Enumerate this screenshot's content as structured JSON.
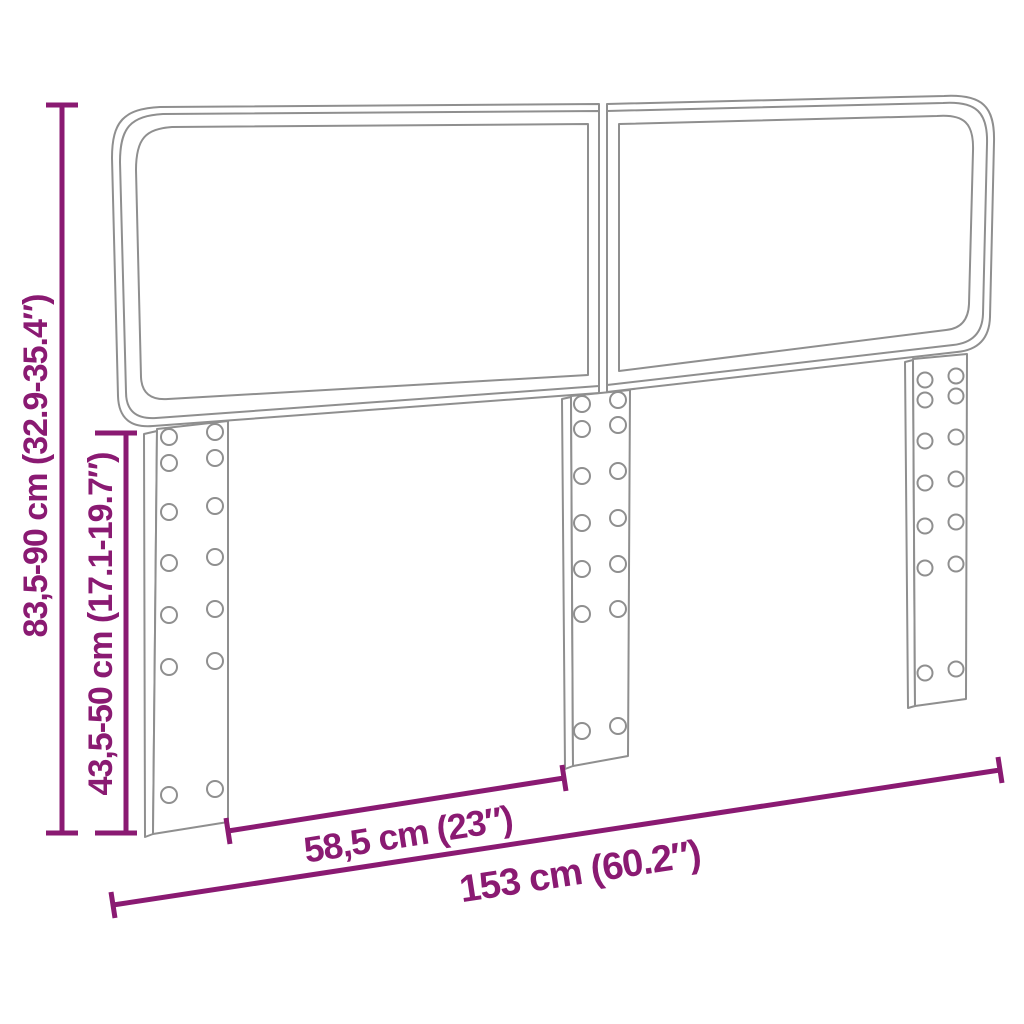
{
  "colors": {
    "dimension": "#8A1A72",
    "outline": "#8F8F8F",
    "background": "#FFFFFF"
  },
  "artwork": {
    "subject": "two-panel upholstered headboard with three mounting legs and screw holes",
    "panels": 2,
    "legs": 3,
    "holes_per_leg": 14
  },
  "dimensions": {
    "total_height": "83,5-90 cm (32.9-35.4″)",
    "leg_height": "43,5-50 cm (17.1-19.7″)",
    "leg_spacing": "58,5 cm (23″)",
    "total_width": "153 cm (60.2″)"
  }
}
